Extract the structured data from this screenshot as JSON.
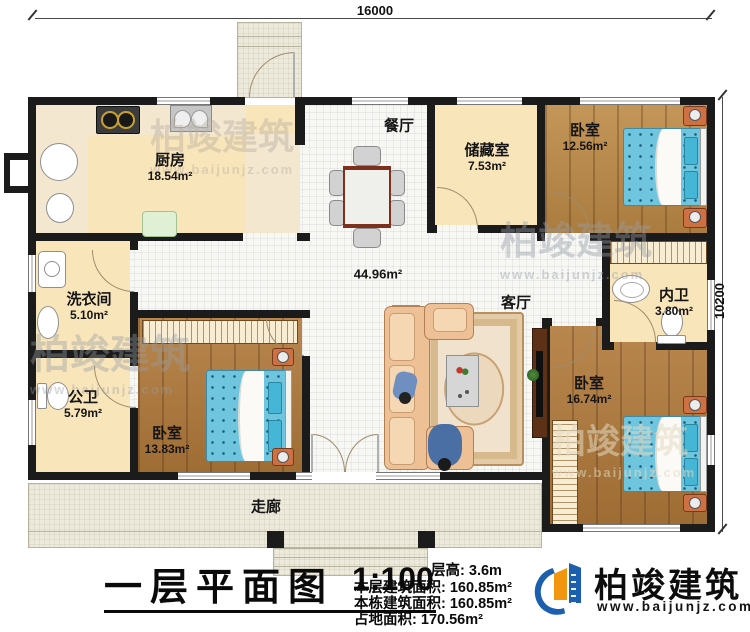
{
  "dimensions": {
    "width_label": "16000",
    "height_label": "10200"
  },
  "rooms": {
    "kitchen": {
      "name": "厨房",
      "area": "18.54m²"
    },
    "dining": {
      "name": "餐厅"
    },
    "storage": {
      "name": "储藏室",
      "area": "7.53m²"
    },
    "bedroom_tr": {
      "name": "卧室",
      "area": "12.56m²"
    },
    "laundry": {
      "name": "洗衣间",
      "area": "5.10m²"
    },
    "bath_public": {
      "name": "公卫",
      "area": "5.79m²"
    },
    "bedroom_bl": {
      "name": "卧室",
      "area": "13.83m²"
    },
    "hall": {
      "area": "44.96m²"
    },
    "living": {
      "name": "客厅"
    },
    "bath_inner": {
      "name": "内卫",
      "area": "3.80m²"
    },
    "bedroom_br": {
      "name": "卧室",
      "area": "16.74m²"
    },
    "corridor": {
      "name": "走廊"
    }
  },
  "title": {
    "text": "一层平面图",
    "scale": "1:100"
  },
  "stats": {
    "floor_height_label": "层高:",
    "floor_height": "3.6m",
    "floor_area_label": "本层建筑面积:",
    "floor_area": "160.85m²",
    "building_area_label": "本栋建筑面积:",
    "building_area": "160.85m²",
    "land_area_label": "占地面积:",
    "land_area": "170.56m²"
  },
  "logo": {
    "name": "柏竣建筑",
    "url": "www.baijunjz.com"
  },
  "watermark": {
    "text": "柏竣建筑",
    "url": "www.baijunjz.com"
  },
  "colors": {
    "wall": "#1b1b1b",
    "wood_floor": "#b0793a",
    "tile_tan": "#d5a46e",
    "bed_blue": "#6fc5de",
    "logo_blue": "#1b5fae",
    "logo_orange": "#f2960f"
  }
}
